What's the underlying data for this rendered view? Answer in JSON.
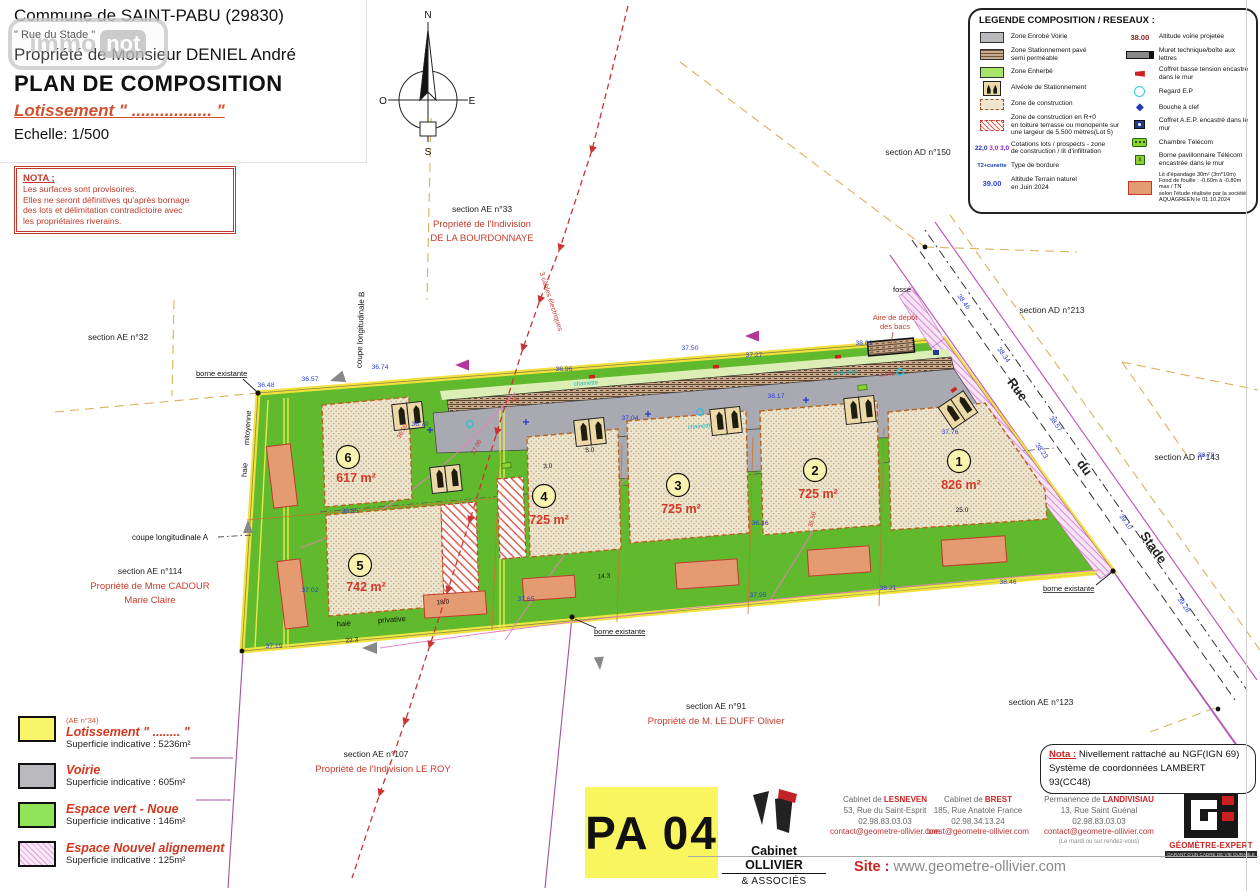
{
  "header": {
    "commune": "Commune de SAINT-PABU (29830)",
    "street": "\" Rue du Stade \"",
    "owner": "Propriété de Monsieur DENIEL André",
    "title": "PLAN DE COMPOSITION",
    "subtitle": "Lotissement \" ................. \"",
    "scale": "Echelle: 1/500",
    "watermark_1": "immo",
    "watermark_2": "not"
  },
  "nota": {
    "title": "NOTA ;",
    "body": "Les surfaces sont provisoires.\nElles ne seront définitives qu'après bornage\ndes lots et délimitation contradictoire avec\nles propriétaires riverains."
  },
  "legend": {
    "title": "LEGENDE COMPOSITION / RESEAUX :",
    "left_items": [
      "Zone Enrobé Voirie",
      "Zone Stationnement pavé\nsemi perméable",
      "Zone Enherbé",
      "Alvéole de Stationnement",
      "Zone de construction",
      "Zone de construction en R+0\nen toiture terrasse ou monopente sur\nune largeur de 5.500 mètres(Lot 5)",
      "Cotations lots / prospects - zone\nde construction / lit d'infiltration",
      "Type de bordure",
      "Altitude Terrain naturel\nen Juin 2024"
    ],
    "right_items": [
      "Altitude voirie projetée",
      "Muret technique/boîte aux lettres",
      "Coffret basse tension encastré dans le mur",
      "Regard E.P",
      "Bouche à clef",
      "Coffret A.E.P. encastré dans le mur",
      "Chambre Télécom",
      "Borne pavillonnaire Télécom\nencastrée dans le mur",
      "Lit d'épandage 30m² (3m*10m)\nFond de fouille : -0.60m à -0.80m max / TN\nselon l'étude réalisée par la société\nAQUAGREEN le 01.10.2024"
    ],
    "samples": {
      "alt_voirie": "38.00",
      "alt_tn": "39.00",
      "cotation": [
        "22,0",
        "3,0",
        "3,0"
      ],
      "bordure": "T2+cunette",
      "tel": "PTT"
    }
  },
  "area_legend": [
    {
      "note": "(AE n°34)",
      "name": "Lotissement \" ........ \"",
      "sup": "Superficie indicative : 5236m²"
    },
    {
      "note": "",
      "name": "Voirie",
      "sup": "Superficie indicative : 605m²"
    },
    {
      "note": "",
      "name": "Espace vert - Noue",
      "sup": "Superficie indicative : 146m²"
    },
    {
      "note": "",
      "name": "Espace Nouvel alignement",
      "sup": "Superficie indicative : 125m²"
    }
  ],
  "map": {
    "lots": [
      {
        "num": "6",
        "area": "617 m²"
      },
      {
        "num": "5",
        "area": "742 m²"
      },
      {
        "num": "4",
        "area": "725 m²"
      },
      {
        "num": "3",
        "area": "725 m²"
      },
      {
        "num": "2",
        "area": "725 m²"
      },
      {
        "num": "1",
        "area": "826 m²"
      }
    ],
    "labels": {
      "ae32": "section AE n°32",
      "ae33": "section AE n°33",
      "ae33_l1": "Propriété de l'Indivision",
      "ae33_l2": "DE LA BOURDONNAYE",
      "ad150": "section AD n°150",
      "ad213": "section AD n°213",
      "ad143": "section AD n°143",
      "ae114": "section AE n°114",
      "ae114_l1": "Propriété de Mme CADOUR",
      "ae114_l2": "Marie Claire",
      "ae107": "section AE n°107",
      "ae107_l1": "Propriété de l'Indivision LE ROY",
      "ae91": "section AE n°91",
      "ae91_l1": "Propriété de M. LE DUFF Olivier",
      "ae123": "section AE n°123",
      "borne": "borne existante",
      "fosse": "fossé",
      "aire1": "Aire de dépôt",
      "aire2": "des bacs",
      "cables": "3 câbles électriques",
      "rue": "Rue",
      "du": "du",
      "stade": "Stade",
      "haie": "haie",
      "mitoyenne": "mitoyenne",
      "privative": "privative",
      "coupeA": "coupe longitudinale A",
      "coupeB": "coupe longitudinale B"
    },
    "compass": {
      "n": "N",
      "s": "S",
      "e": "E",
      "o": "O"
    },
    "altitudes": [
      "36.48",
      "36.57",
      "36.74",
      "36.96",
      "37.27",
      "37.50",
      "38.09",
      "37.76",
      "38.17",
      "36.70",
      "36.85",
      "37.02",
      "37.19",
      "37.65",
      "37.95",
      "38.21",
      "38.46",
      "38.78",
      "36.36",
      "37.04",
      "38.46",
      "38.34",
      "38.57",
      "39.10",
      "39.28",
      "38.23"
    ],
    "dims": [
      "22.3",
      "18.0",
      "14.3",
      "25.0",
      "5.0",
      "3.0"
    ],
    "rednotes": [
      "36.50",
      "37.06",
      "36.50",
      "-1.5%",
      "-2%"
    ],
    "chainette": "chainette"
  },
  "titleblock": {
    "pa": "PA 04",
    "firm_name": "Cabinet OLLIVIER",
    "firm_sub": "& ASSOCIÉS",
    "offices": [
      {
        "prefix": "Cabinet de ",
        "name": "LESNEVEN",
        "addr": "53, Rue du Saint-Esprit",
        "tel": "02.98.83.03.03",
        "mail": "contact@geometre-ollivier.com",
        "note": ""
      },
      {
        "prefix": "Cabinet de ",
        "name": "BREST",
        "addr": "185, Rue Anatole France",
        "tel": "02.98.34.13.24",
        "mail": "brest@geometre-ollivier.com",
        "note": ""
      },
      {
        "prefix": "Permanence de ",
        "name": "LANDIVISIAU",
        "addr": "13, Rue Saint Guénal",
        "tel": "02.98.83.03.03",
        "mail": "contact@geometre-ollivier.com",
        "note": "(Le mardi ou sur rendez-vous)"
      }
    ],
    "ref": "REF : 24102-PA04   le 21.01.2025 M-LM",
    "ngf_label": "Nota :",
    "ngf_1": " Nivellement rattaché au NGF(IGN 69)",
    "ngf_2": "Système de coordonnées LAMBERT 93(CC48)",
    "site_label": "Site :",
    "site_url": "www.geometre-ollivier.com",
    "ge_name": "GÉOMÈTRE-EXPERT",
    "ge_tag": "GARANT D'UN CADRE DE VIE DURABLE"
  }
}
